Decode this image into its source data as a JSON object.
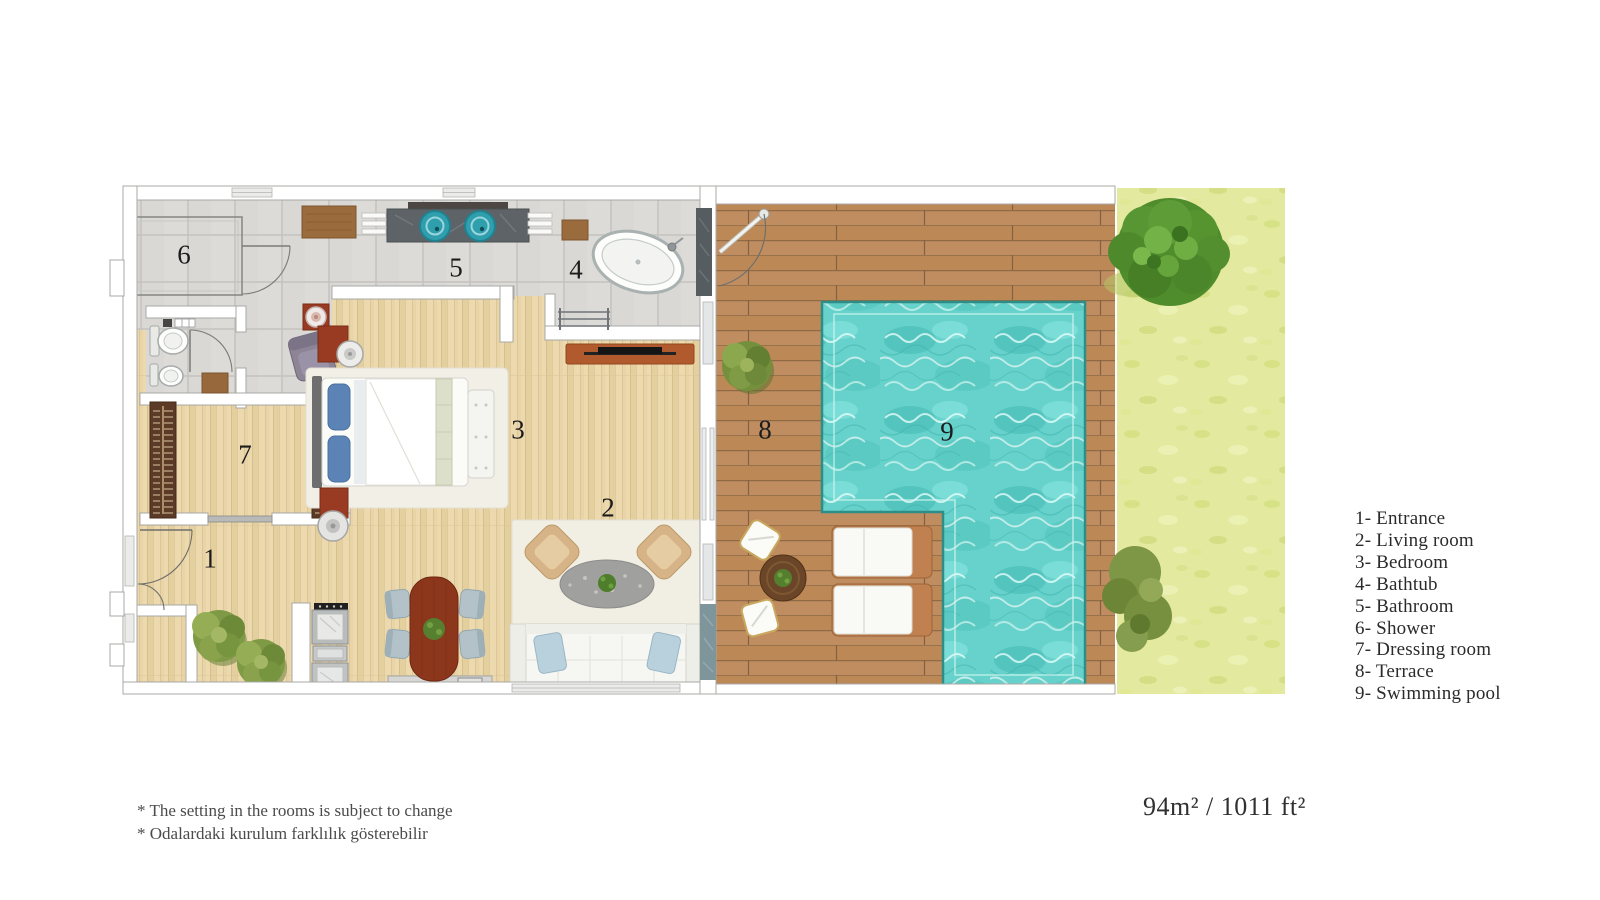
{
  "plan": {
    "room_numbers": [
      "1",
      "2",
      "3",
      "4",
      "5",
      "6",
      "7",
      "8",
      "9"
    ]
  },
  "legend": {
    "items": [
      "1- Entrance",
      "2- Living room",
      "3- Bedroom",
      "4- Bathtub",
      "5- Bathroom",
      "6- Shower",
      "7- Dressing room",
      "8- Terrace",
      "9- Swimming pool"
    ]
  },
  "footnotes": {
    "line1": "* The setting in the rooms is subject to change",
    "line2": "* Odalardaki kurulum farklılık gösterebilir"
  },
  "area_label": "94m² / 1011 ft²",
  "colors": {
    "pool_water": "#67d2cb",
    "pool_border": "#2f8d87",
    "deck_wood": "#c08d61",
    "interior_wood": "#ecd9ae",
    "tile": "#d8d7d4",
    "grass": "#e3e99f",
    "tree_green": "#4f8c2c",
    "wall_outline": "#a8a8a6",
    "sink_teal": "#2f9fae",
    "dark_wood_furniture": "#993b22",
    "wardrobe_brown": "#5b3a27",
    "text": "#2b2b2b"
  }
}
